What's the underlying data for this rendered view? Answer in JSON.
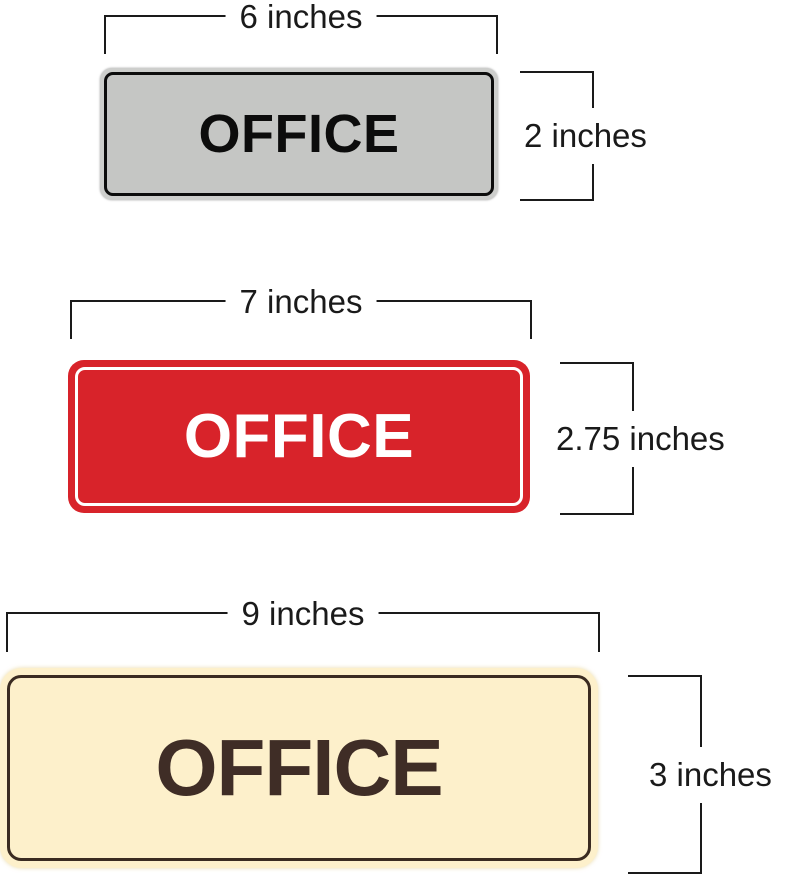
{
  "page": {
    "background": "#ffffff",
    "dimension_line_color": "#1a1a1a"
  },
  "signs": [
    {
      "id": "gray-office-sign",
      "text": "OFFICE",
      "width_label": "6 inches",
      "height_label": "2 inches",
      "colors": {
        "frame": "#cdcecc",
        "fill": "#c5c6c4",
        "border": "#0c0c0c",
        "text": "#0c0c0c"
      }
    },
    {
      "id": "red-office-sign",
      "text": "OFFICE",
      "width_label": "7 inches",
      "height_label": "2.75 inches",
      "colors": {
        "fill": "#d8232a",
        "border": "#ffffff",
        "text": "#ffffff"
      }
    },
    {
      "id": "cream-office-sign",
      "text": "OFFICE",
      "width_label": "9 inches",
      "height_label": "3 inches",
      "colors": {
        "fill": "#fdf0cb",
        "border": "#3a2b21",
        "text": "#3f2d26"
      }
    }
  ]
}
